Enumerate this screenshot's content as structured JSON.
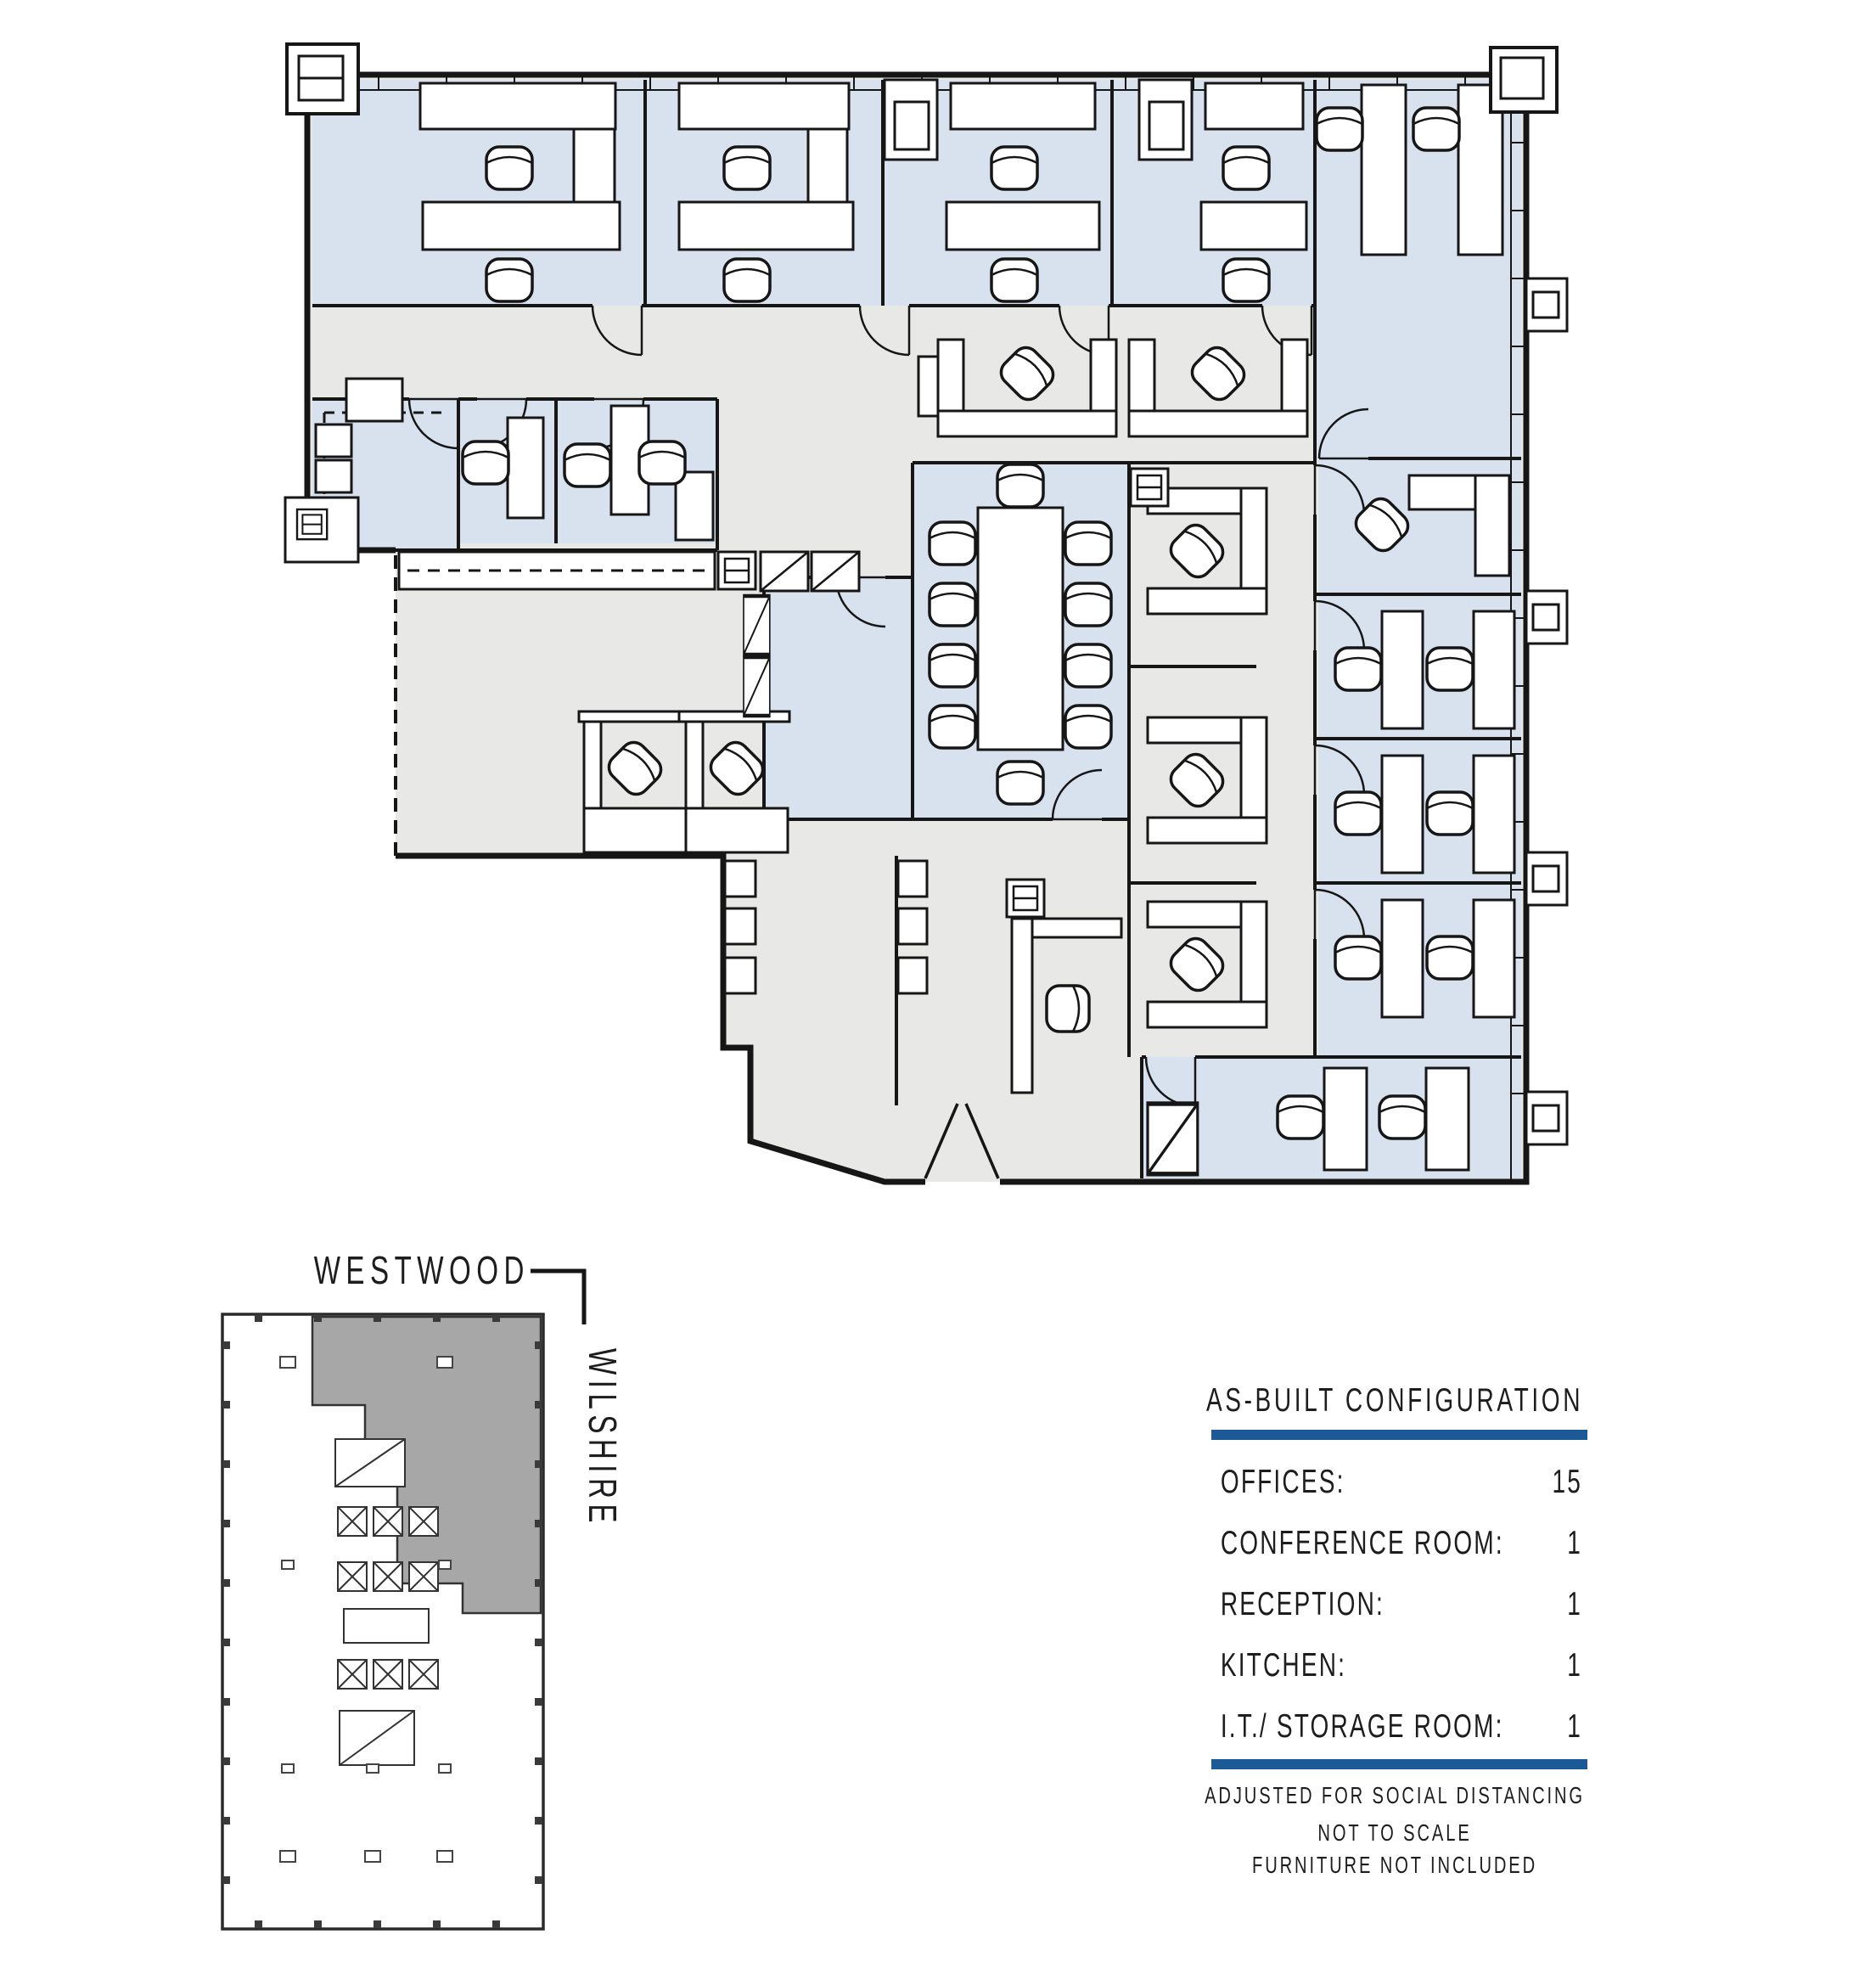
{
  "legend": {
    "title": "AS-BUILT CONFIGURATION",
    "rows": [
      {
        "label": "OFFICES:",
        "value": "15"
      },
      {
        "label": "CONFERENCE ROOM:",
        "value": "1"
      },
      {
        "label": "RECEPTION:",
        "value": "1"
      },
      {
        "label": "KITCHEN:",
        "value": "1"
      },
      {
        "label": "I.T./ STORAGE ROOM:",
        "value": "1"
      }
    ],
    "notes": [
      "ADJUSTED FOR SOCIAL DISTANCING",
      "NOT TO SCALE",
      "FURNITURE NOT INCLUDED"
    ]
  },
  "key_plan": {
    "street_top": "WESTWOOD",
    "street_right": "WILSHIRE"
  },
  "colors": {
    "office_fill": "#d8e2ee",
    "circulation_fill": "#e8e8e6",
    "wall": "#161616",
    "accent_rule": "#1b5a96",
    "keyplan_suite_fill": "#a7a7a7"
  }
}
